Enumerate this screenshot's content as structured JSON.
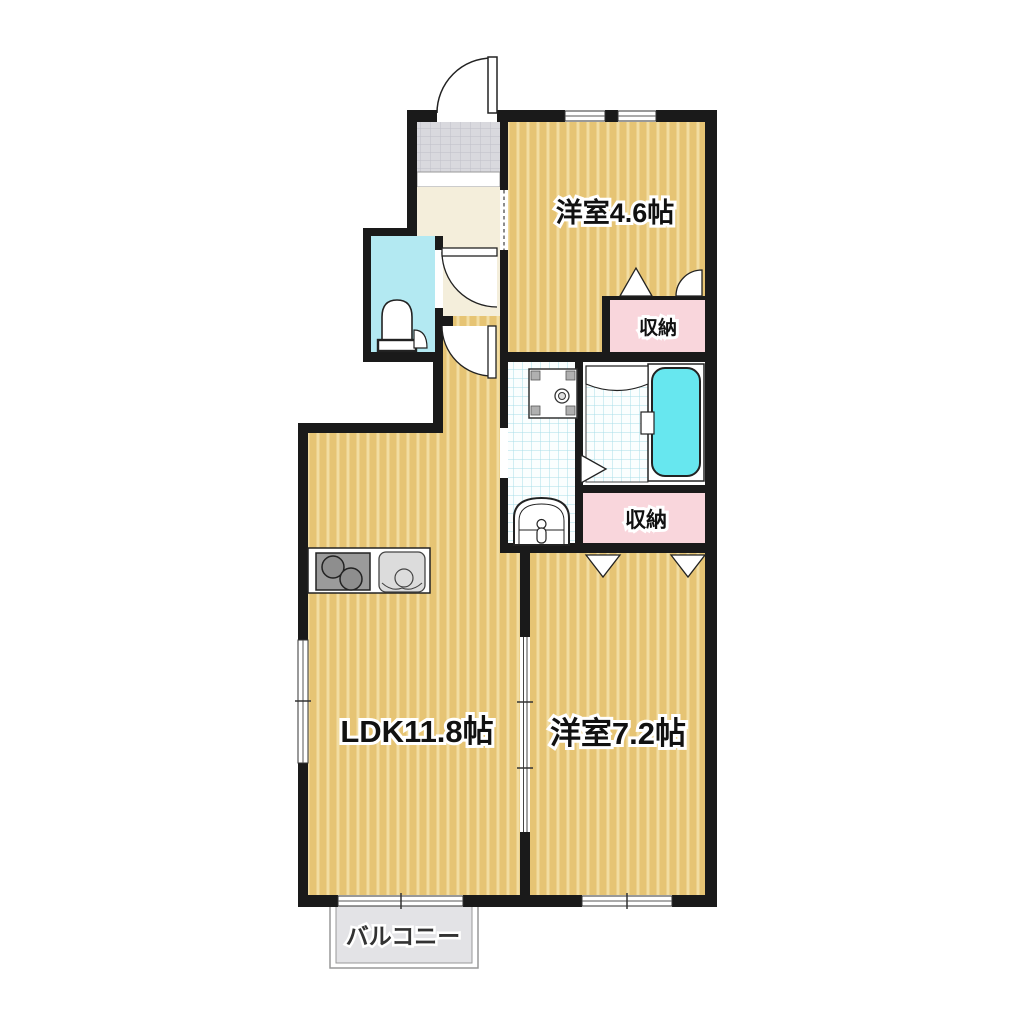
{
  "plan": {
    "type": "japanese-apartment-floor-plan",
    "rooms": {
      "western_room_1": {
        "label": "洋室4.6帖"
      },
      "ldk": {
        "label": "LDK11.8帖"
      },
      "western_room_2": {
        "label": "洋室7.2帖"
      },
      "storage_top": {
        "label": "収納"
      },
      "storage_bottom": {
        "label": "収納"
      },
      "balcony": {
        "label": "バルコニー"
      }
    },
    "fixtures": [
      "entrance-door-icon",
      "toilet-icon",
      "washbasin-icon",
      "washing-machine-pan-icon",
      "bathtub-icon",
      "shower-room-icon",
      "kitchen-stove-icon",
      "kitchen-sink-icon",
      "closet-folding-door-icon",
      "sliding-partition-icon",
      "window-icon"
    ],
    "colors": {
      "wall": "#1a1a1a",
      "wood_floor": "#e6c474",
      "wood_stripe": "#f2dda2",
      "hallway": "#f4eedb",
      "toilet_room": "#b3e9f2",
      "bathtub": "#67e7ef",
      "tile_bg": "#fbfefe",
      "tile_line": "#a9dde8",
      "storage_pink": "#f9d6dc",
      "entry_gray": "#d9d9de",
      "balcony_gray": "#e3e3e6"
    }
  }
}
